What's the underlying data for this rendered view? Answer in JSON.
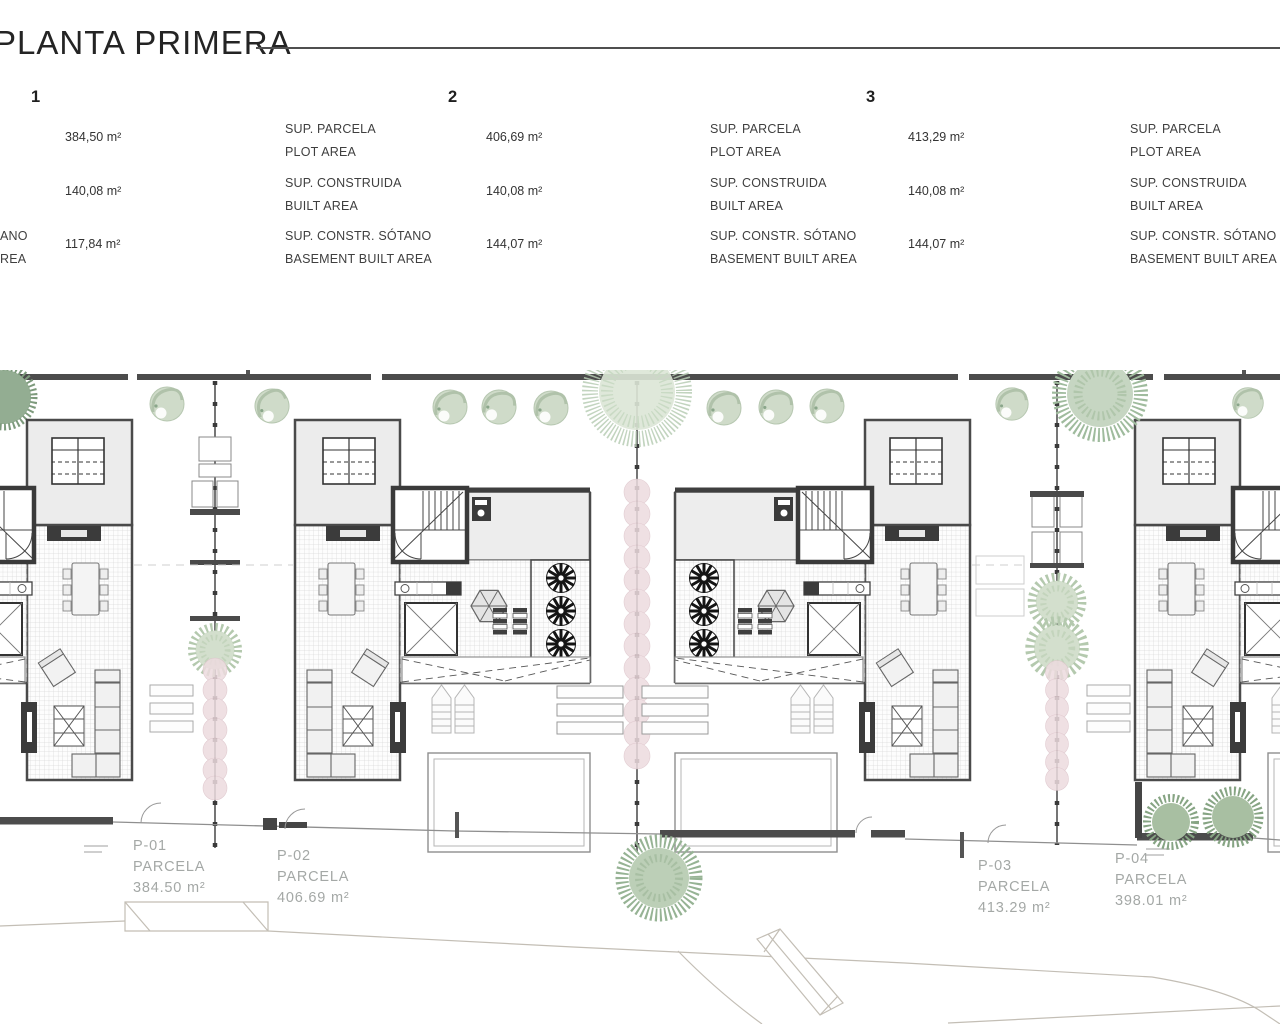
{
  "page": {
    "title": "PLANTA PRIMERA"
  },
  "units": [
    {
      "number": "1",
      "rows": [
        {
          "label_es": "",
          "label_en": "",
          "value": "384,50 m²"
        },
        {
          "label_es": "",
          "label_en": "",
          "value": "140,08 m²"
        },
        {
          "label_es": "ANO",
          "label_en": "REA",
          "value": "117,84 m²"
        }
      ]
    },
    {
      "number": "2",
      "rows": [
        {
          "label_es": "SUP. PARCELA",
          "label_en": "PLOT AREA",
          "value": "406,69 m²"
        },
        {
          "label_es": "SUP. CONSTRUIDA",
          "label_en": "BUILT AREA",
          "value": "140,08 m²"
        },
        {
          "label_es": "SUP. CONSTR. SÓTANO",
          "label_en": "BASEMENT BUILT AREA",
          "value": "144,07 m²"
        }
      ]
    },
    {
      "number": "3",
      "rows": [
        {
          "label_es": "SUP. PARCELA",
          "label_en": "PLOT AREA",
          "value": "413,29 m²"
        },
        {
          "label_es": "SUP. CONSTRUIDA",
          "label_en": "BUILT AREA",
          "value": "140,08 m²"
        },
        {
          "label_es": "SUP. CONSTR. SÓTANO",
          "label_en": "BASEMENT BUILT AREA",
          "value": "144,07 m²"
        }
      ]
    },
    {
      "number": "",
      "rows": [
        {
          "label_es": "SUP. PARCELA",
          "label_en": "PLOT AREA",
          "value": ""
        },
        {
          "label_es": "SUP. CONSTRUIDA",
          "label_en": "BUILT AREA",
          "value": ""
        },
        {
          "label_es": "SUP. CONSTR. SÓTANO",
          "label_en": "BASEMENT BUILT AREA",
          "value": ""
        }
      ]
    }
  ],
  "parcels": [
    {
      "id": "P-01",
      "label": "PARCELA",
      "area": "384.50 m²"
    },
    {
      "id": "P-02",
      "label": "PARCELA",
      "area": "406.69 m²"
    },
    {
      "id": "P-03",
      "label": "PARCELA",
      "area": "413.29 m²"
    },
    {
      "id": "P-04",
      "label": "PARCELA",
      "area": "398.01 m²"
    }
  ],
  "colors": {
    "wall_dark": "#4c4c4c",
    "text_dark": "#2d2d2d",
    "parcel_text_gray": "#a4a8a6",
    "hedge_pink": "#eddbdf",
    "tree_green_light": "#cfdbc9",
    "tree_green_dark": "#8fa98f",
    "tile_line": "#d8d8d8"
  }
}
